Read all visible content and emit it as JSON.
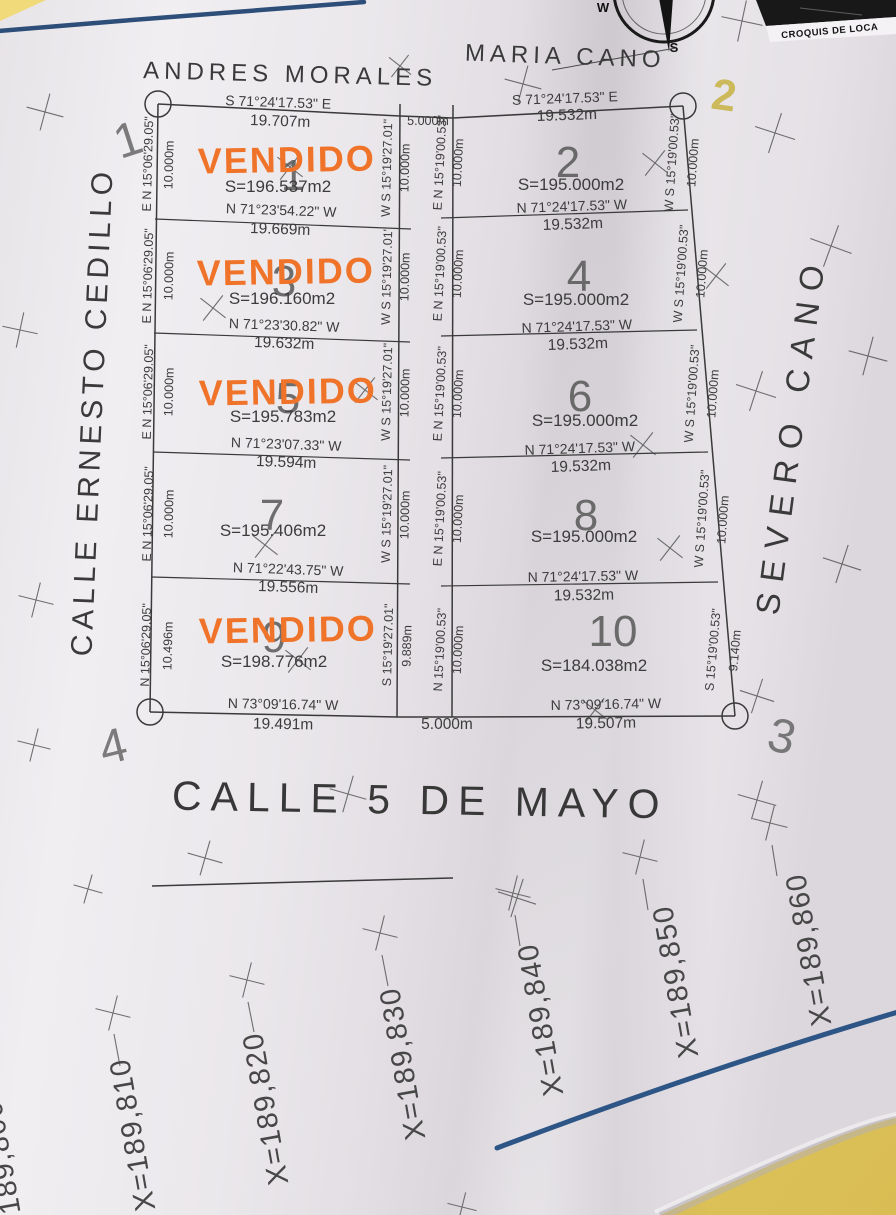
{
  "photo": {
    "croquis_label": "CROQUIS DE LOCA",
    "compass": {
      "west": "W",
      "south": "S"
    }
  },
  "colors": {
    "stamp_orange": "#f0732a",
    "pen_blue": "#2d5180",
    "table_yellow": "#e6cd67",
    "paper": "#ebe8ec"
  },
  "streets": {
    "top_left_owner": "ANDRES MORALES",
    "top_right_owner": "MARIA CANO",
    "left_street": "CALLE ERNESTO CEDILLO",
    "right_owner": "SEVERO CANO",
    "bottom_street": "CALLE 5 DE MAYO"
  },
  "corners": {
    "c1": "1",
    "c2_handwritten": "2",
    "c3": "3",
    "c4": "4"
  },
  "corridor": {
    "top_width": "5.000m",
    "bottom_width": "5.000m"
  },
  "stamp_text": "VENDIDO",
  "grid_labels": {
    "x_partial": "X=189,800",
    "x_values": [
      "X=189,810",
      "X=189,820",
      "X=189,830",
      "X=189,840",
      "X=189,850",
      "X=189,860"
    ]
  },
  "lots": {
    "left": [
      {
        "number": "1",
        "area": "S=196.537m2",
        "sold": true,
        "top_bearing": "S 71°24'17.53\" E",
        "top_dist": "19.707m",
        "bottom_bearing": "N 71°23'54.22\" W",
        "bottom_dist": "19.669m",
        "left_bearing": "E N 15°06'29.05\"",
        "left_dist": "10.000m",
        "right_bearing": "W S 15°19'27.01\"",
        "right_dist": "10.000m"
      },
      {
        "number": "3",
        "area": "S=196.160m2",
        "sold": true,
        "bottom_bearing": "N 71°23'30.82\" W",
        "bottom_dist": "19.632m",
        "left_bearing": "E N 15°06'29.05\"",
        "left_dist": "10.000m",
        "right_bearing": "W S 15°19'27.01\"",
        "right_dist": "10.000m"
      },
      {
        "number": "5",
        "area": "S=195.783m2",
        "sold": true,
        "bottom_bearing": "N 71°23'07.33\" W",
        "bottom_dist": "19.594m",
        "left_bearing": "E N 15°06'29.05\"",
        "left_dist": "10.000m",
        "right_bearing": "W S 15°19'27.01\"",
        "right_dist": "10.000m"
      },
      {
        "number": "7",
        "area": "S=195.406m2",
        "sold": false,
        "bottom_bearing": "N 71°22'43.75\" W",
        "bottom_dist": "19.556m",
        "left_bearing": "E N 15°06'29.05\"",
        "left_dist": "10.000m",
        "right_bearing": "W S 15°19'27.01\"",
        "right_dist": "10.000m"
      },
      {
        "number": "9",
        "area": "S=198.776m2",
        "sold": true,
        "bottom_bearing": "N 73°09'16.74\" W",
        "bottom_dist": "19.491m",
        "left_bearing": "N 15°06'29.05\"",
        "left_dist": "10.496m",
        "right_bearing": "S 15°19'27.01\"",
        "right_dist": "9.889m"
      }
    ],
    "right": [
      {
        "number": "2",
        "area": "S=195.000m2",
        "sold": false,
        "top_bearing": "S 71°24'17.53\" E",
        "top_dist": "19.532m",
        "bottom_bearing": "N 71°24'17.53\" W",
        "bottom_dist": "19.532m",
        "left_bearing": "E N 15°19'00.53\"",
        "left_dist": "10.000m",
        "right_bearing": "W S 15°19'00.53\"",
        "right_dist": "10.000m"
      },
      {
        "number": "4",
        "area": "S=195.000m2",
        "sold": false,
        "bottom_bearing": "N 71°24'17.53\" W",
        "bottom_dist": "19.532m",
        "left_bearing": "E N 15°19'00.53\"",
        "left_dist": "10.000m",
        "right_bearing": "W S 15°19'00.53\"",
        "right_dist": "10.000m"
      },
      {
        "number": "6",
        "area": "S=195.000m2",
        "sold": false,
        "bottom_bearing": "N 71°24'17.53\" W",
        "bottom_dist": "19.532m",
        "left_bearing": "E N 15°19'00.53\"",
        "left_dist": "10.000m",
        "right_bearing": "W S 15°19'00.53\"",
        "right_dist": "10.000m"
      },
      {
        "number": "8",
        "area": "S=195.000m2",
        "sold": false,
        "bottom_bearing": "N 71°24'17.53\" W",
        "bottom_dist": "19.532m",
        "left_bearing": "E N 15°19'00.53\"",
        "left_dist": "10.000m",
        "right_bearing": "W S 15°19'00.53\"",
        "right_dist": "10.000m"
      },
      {
        "number": "10",
        "area": "S=184.038m2",
        "sold": false,
        "bottom_bearing": "N 73°09'16.74\" W",
        "bottom_dist": "19.507m",
        "left_bearing": "N 15°19'00.53\"",
        "left_dist": "10.000m",
        "right_bearing": "S 15°19'00.53\"",
        "right_dist": "9.140m"
      }
    ]
  }
}
